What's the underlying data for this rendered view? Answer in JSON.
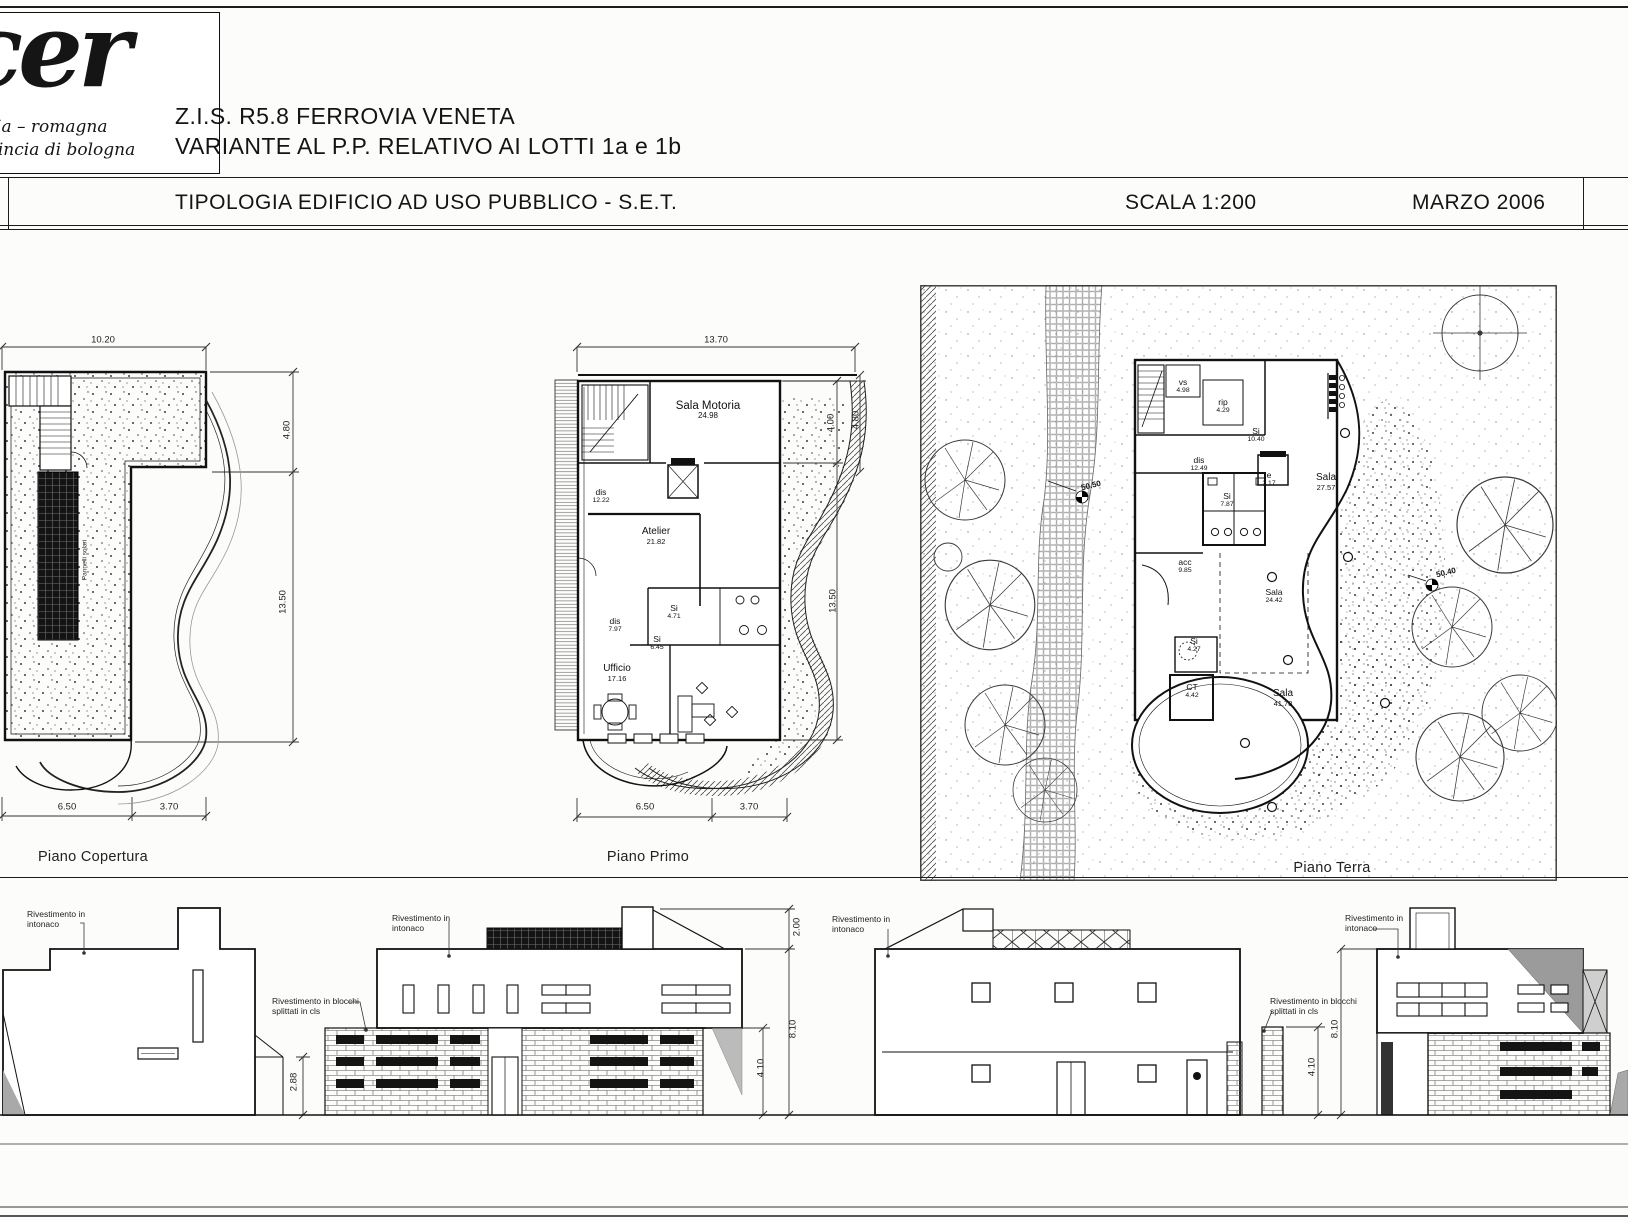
{
  "header": {
    "logo_brand": "cer",
    "logo_region": "emilia – romagna",
    "logo_province": "provincia di bologna",
    "title_line1": "Z.I.S. R5.8 FERROVIA VENETA",
    "title_line2": "VARIANTE AL P.P. RELATIVO AI LOTTI 1a e 1b",
    "subtitle": "TIPOLOGIA EDIFICIO AD USO PUBBLICO - S.E.T.",
    "scale_label": "SCALA 1:200",
    "date_label": "MARZO 2006"
  },
  "plans": {
    "copertura": {
      "caption": "Piano Copertura",
      "solar_label": "Pannelli solari",
      "dims": {
        "top": "10.20",
        "right_upper": "4.80",
        "right_lower": "13.50",
        "bottom_left": "6.50",
        "bottom_right": "3.70"
      }
    },
    "primo": {
      "caption": "Piano Primo",
      "dims": {
        "top": "13.70",
        "right_inner": "4.00",
        "right_outer": "4.80",
        "right_lower": "13.50",
        "bottom_left": "6.50",
        "bottom_right": "3.70"
      },
      "rooms": [
        {
          "name": "Sala Motoria",
          "area": "24.98"
        },
        {
          "name": "dis",
          "area": "12.22"
        },
        {
          "name": "Atelier",
          "area": "21.82"
        },
        {
          "name": "dis",
          "area": "7.97"
        },
        {
          "name": "Si",
          "area": "4.71"
        },
        {
          "name": "Si",
          "area": "6.45"
        },
        {
          "name": "Ufficio",
          "area": "17.16"
        }
      ]
    },
    "terra": {
      "caption": "Piano Terra",
      "rooms": [
        {
          "name": "vs",
          "area": "4.98"
        },
        {
          "name": "rip",
          "area": "4.29"
        },
        {
          "name": "Si",
          "area": "10.40"
        },
        {
          "name": "dis",
          "area": "12.49"
        },
        {
          "name": "e",
          "area": "2.17"
        },
        {
          "name": "Si",
          "area": "7.87"
        },
        {
          "name": "Sala",
          "area": "27.57"
        },
        {
          "name": "acc",
          "area": "9.85"
        },
        {
          "name": "Sala",
          "area": "24.42"
        },
        {
          "name": "Si",
          "area": "4.27"
        },
        {
          "name": "CT",
          "area": "4.42"
        },
        {
          "name": "Sala",
          "area": "41.78"
        }
      ],
      "spot_elevations": [
        "50.50",
        "50.40"
      ]
    }
  },
  "elevations": {
    "note_intonaco": "Rivestimento in intonaco",
    "note_blocchi": "Rivestimento in blocchi splittati in cls",
    "dims": {
      "h_288": "2.88",
      "h_200": "2.00",
      "h_810": "8.10",
      "h_410": "4.10"
    }
  }
}
